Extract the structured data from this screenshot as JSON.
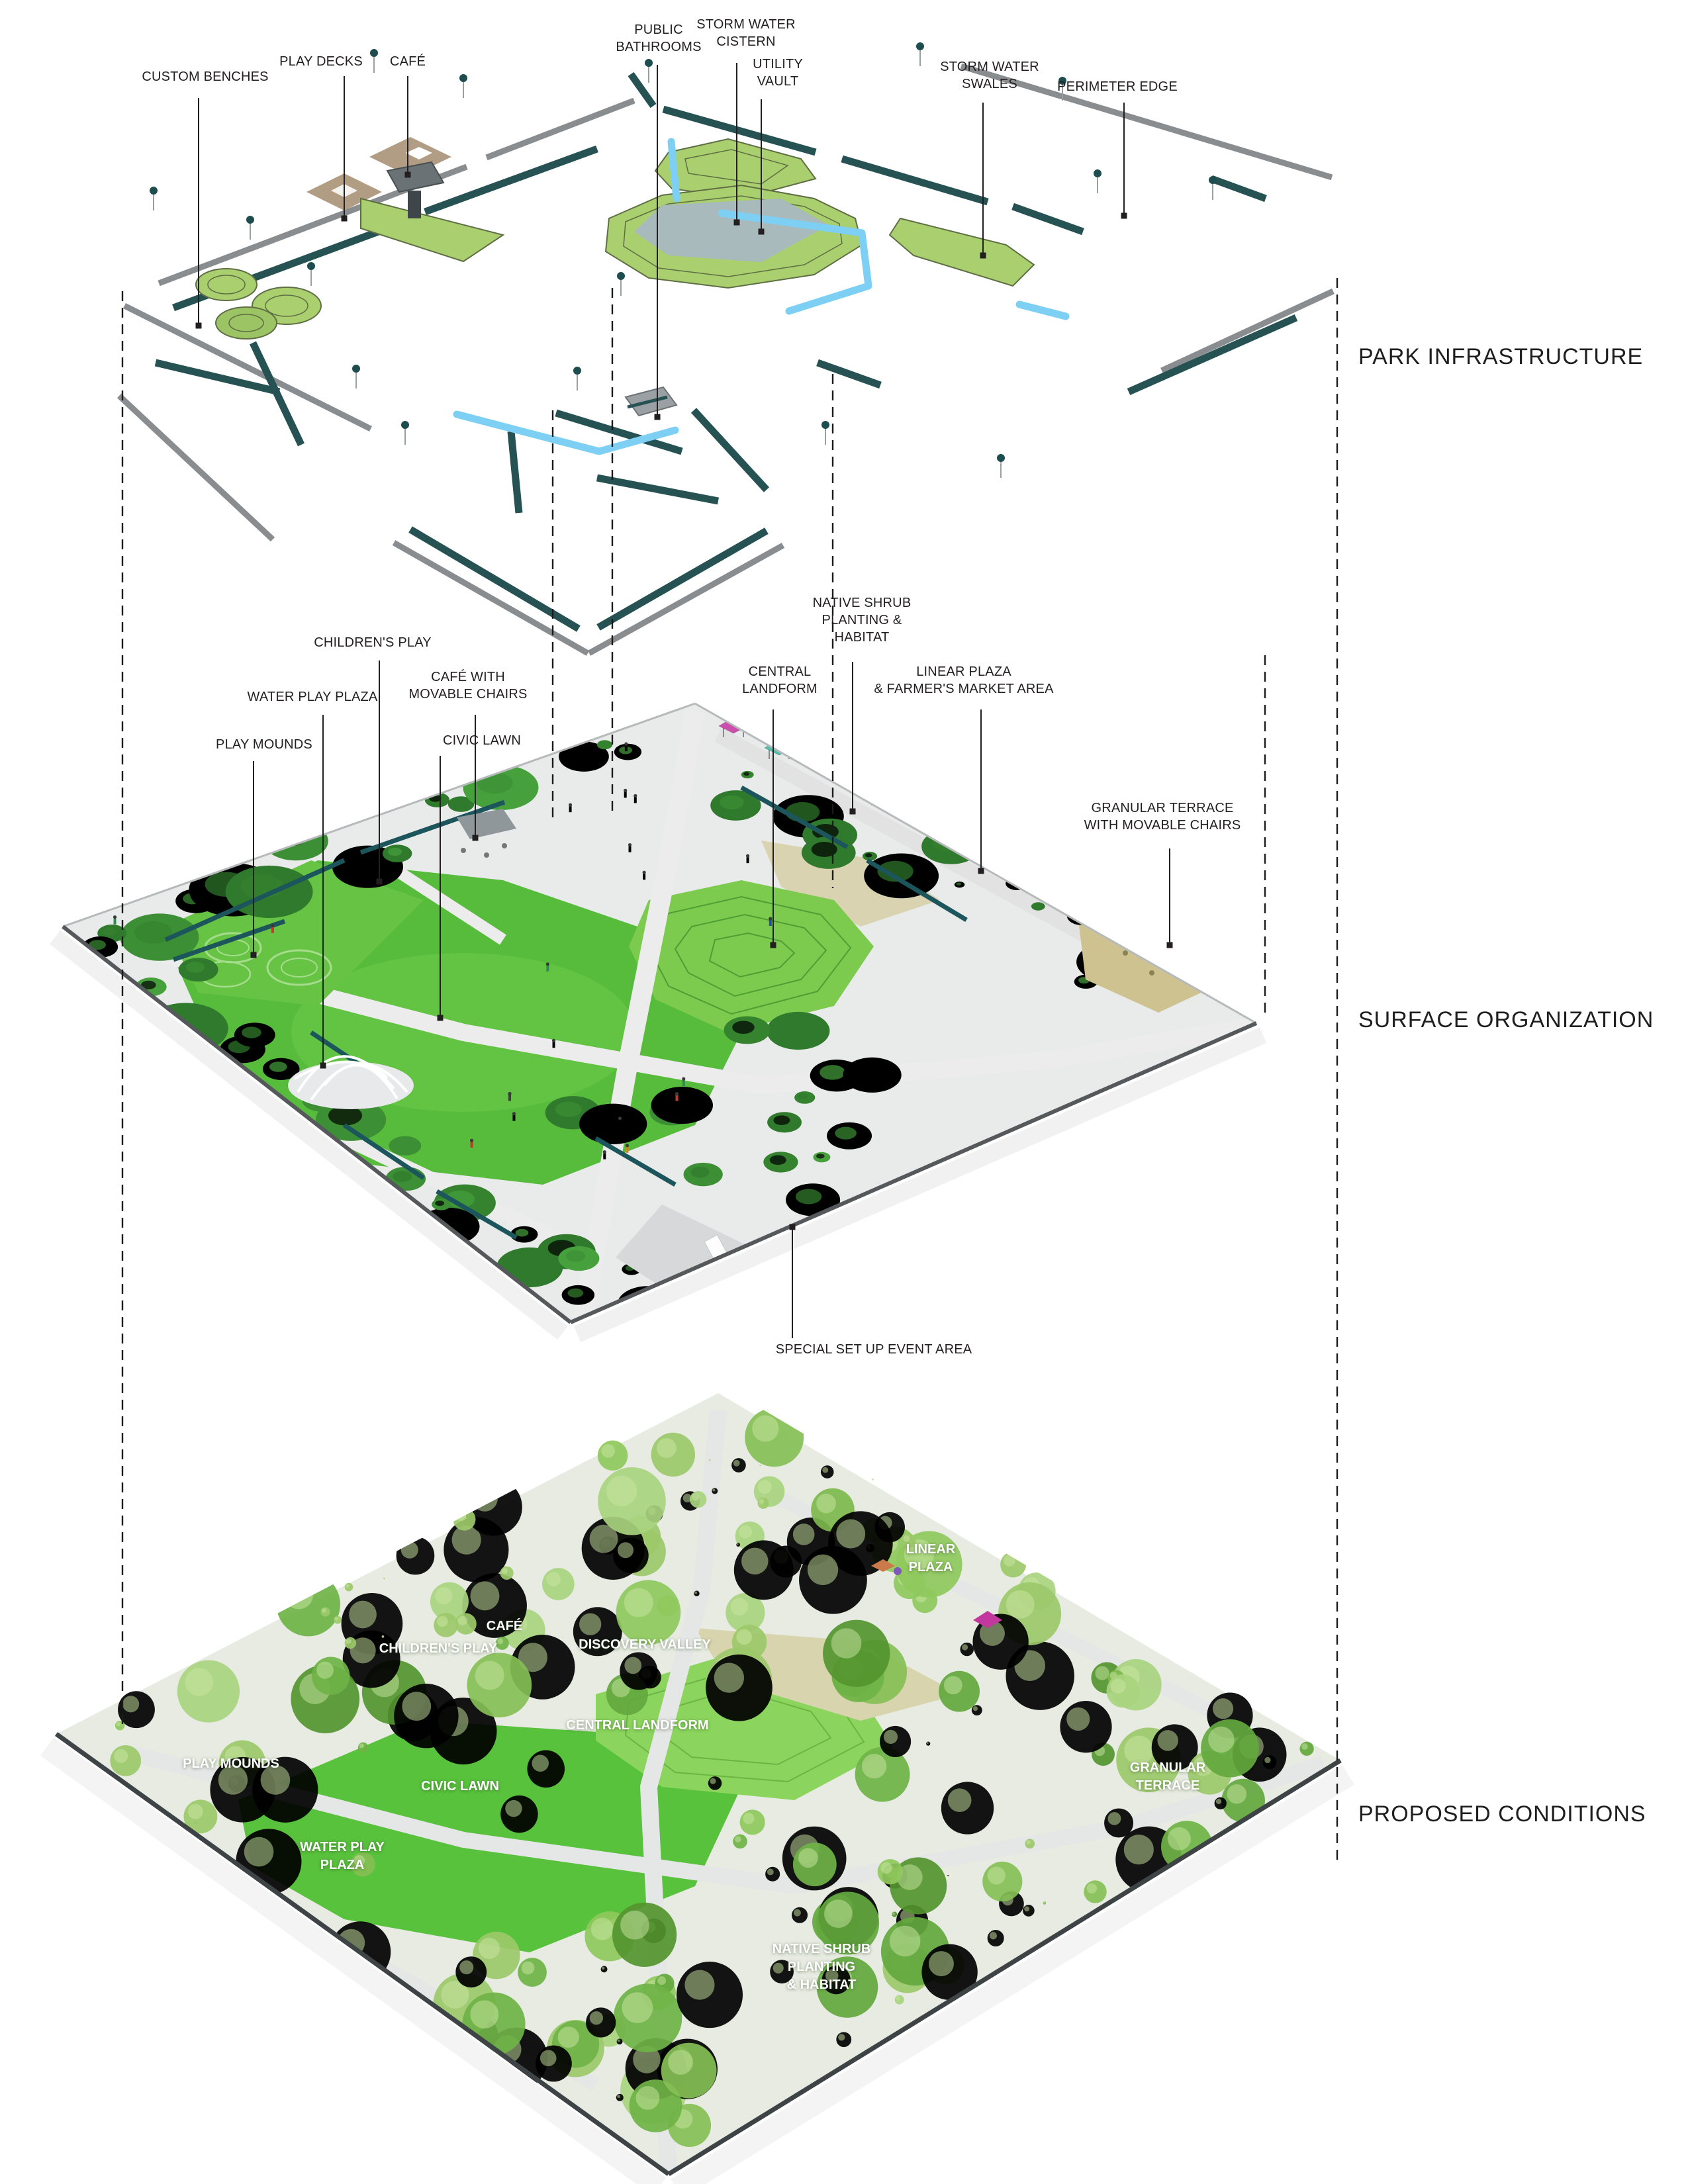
{
  "document": {
    "background": "#ffffff",
    "label_color_dark": "#231f20",
    "label_color_light": "#ffffff"
  },
  "sections": [
    {
      "id": "park-infrastructure",
      "title": "PARK INFRASTRUCTURE"
    },
    {
      "id": "surface-organization",
      "title": "SURFACE ORGANIZATION"
    },
    {
      "id": "proposed-conditions",
      "title": "PROPOSED CONDITIONS"
    }
  ],
  "infrastructure_labels": [
    {
      "text": "CUSTOM BENCHES"
    },
    {
      "text": "PLAY DECKS"
    },
    {
      "text": "CAFÉ"
    },
    {
      "text": "PUBLIC\nBATHROOMS"
    },
    {
      "text": "STORM WATER\nCISTERN"
    },
    {
      "text": "UTILITY\nVAULT"
    },
    {
      "text": "STORM WATER\nSWALES"
    },
    {
      "text": "PERIMETER EDGE"
    }
  ],
  "surface_labels": [
    {
      "text": "CHILDREN'S PLAY"
    },
    {
      "text": "WATER PLAY PLAZA"
    },
    {
      "text": "CAFÉ WITH\nMOVABLE CHAIRS"
    },
    {
      "text": "CIVIC LAWN"
    },
    {
      "text": "PLAY MOUNDS"
    },
    {
      "text": "CENTRAL\nLANDFORM"
    },
    {
      "text": "NATIVE SHRUB\nPLANTING &\nHABITAT"
    },
    {
      "text": "LINEAR PLAZA\n& FARMER'S MARKET AREA"
    },
    {
      "text": "GRANULAR TERRACE\nWITH MOVABLE CHAIRS"
    },
    {
      "text": "SPECIAL SET UP EVENT AREA"
    }
  ],
  "proposed_labels": [
    {
      "text": "LINEAR\nPLAZA"
    },
    {
      "text": "CAFÉ"
    },
    {
      "text": "CHILDREN'S PLAY"
    },
    {
      "text": "DISCOVERY VALLEY"
    },
    {
      "text": "CENTRAL LANDFORM"
    },
    {
      "text": "PLAY MOUNDS"
    },
    {
      "text": "CIVIC LAWN"
    },
    {
      "text": "WATER PLAY\nPLAZA"
    },
    {
      "text": "GRANULAR\nTERRACE"
    },
    {
      "text": "NATIVE SHRUB\nPLANTING\n& HABITAT"
    }
  ],
  "palette": {
    "bench_teal": "#265254",
    "rail_gray": "#8a8d90",
    "deck_tan": "#b19d83",
    "water_blue": "#7dd0f4",
    "cistern_water": "#a9babc",
    "contour_green": "#a9cf6e",
    "contour_stroke": "#5f6e44",
    "lawn_green": "#57bb3b",
    "landform_green": "#7ccb4e",
    "path_gray": "#ececec",
    "wall_teal": "#1c565c",
    "granular_tan": "#cfc291",
    "shrub_greens": [
      "#2f7a2c",
      "#3c8f35",
      "#46a03c",
      "#35822f"
    ],
    "tree_greens": [
      "#9cc96a",
      "#7db84d",
      "#63a83e",
      "#8fc95d",
      "#54952f",
      "#a9d47f",
      "#6fb347",
      "#86bf55"
    ],
    "tree_highlight": "#c9e6a2",
    "people_colors": [
      "#c0392b",
      "#2e4a9e",
      "#3d3d3d",
      "#d98327",
      "#7d3f98",
      "#2e8b57"
    ],
    "market_tent_colors": [
      "#cc4fae",
      "#cd8660",
      "#4fbfae",
      "#bdb05a",
      "#7f58b8",
      "#62c9b2",
      "#b5a94e",
      "#b93fa7",
      "#cfc163",
      "#57c2ad"
    ]
  }
}
